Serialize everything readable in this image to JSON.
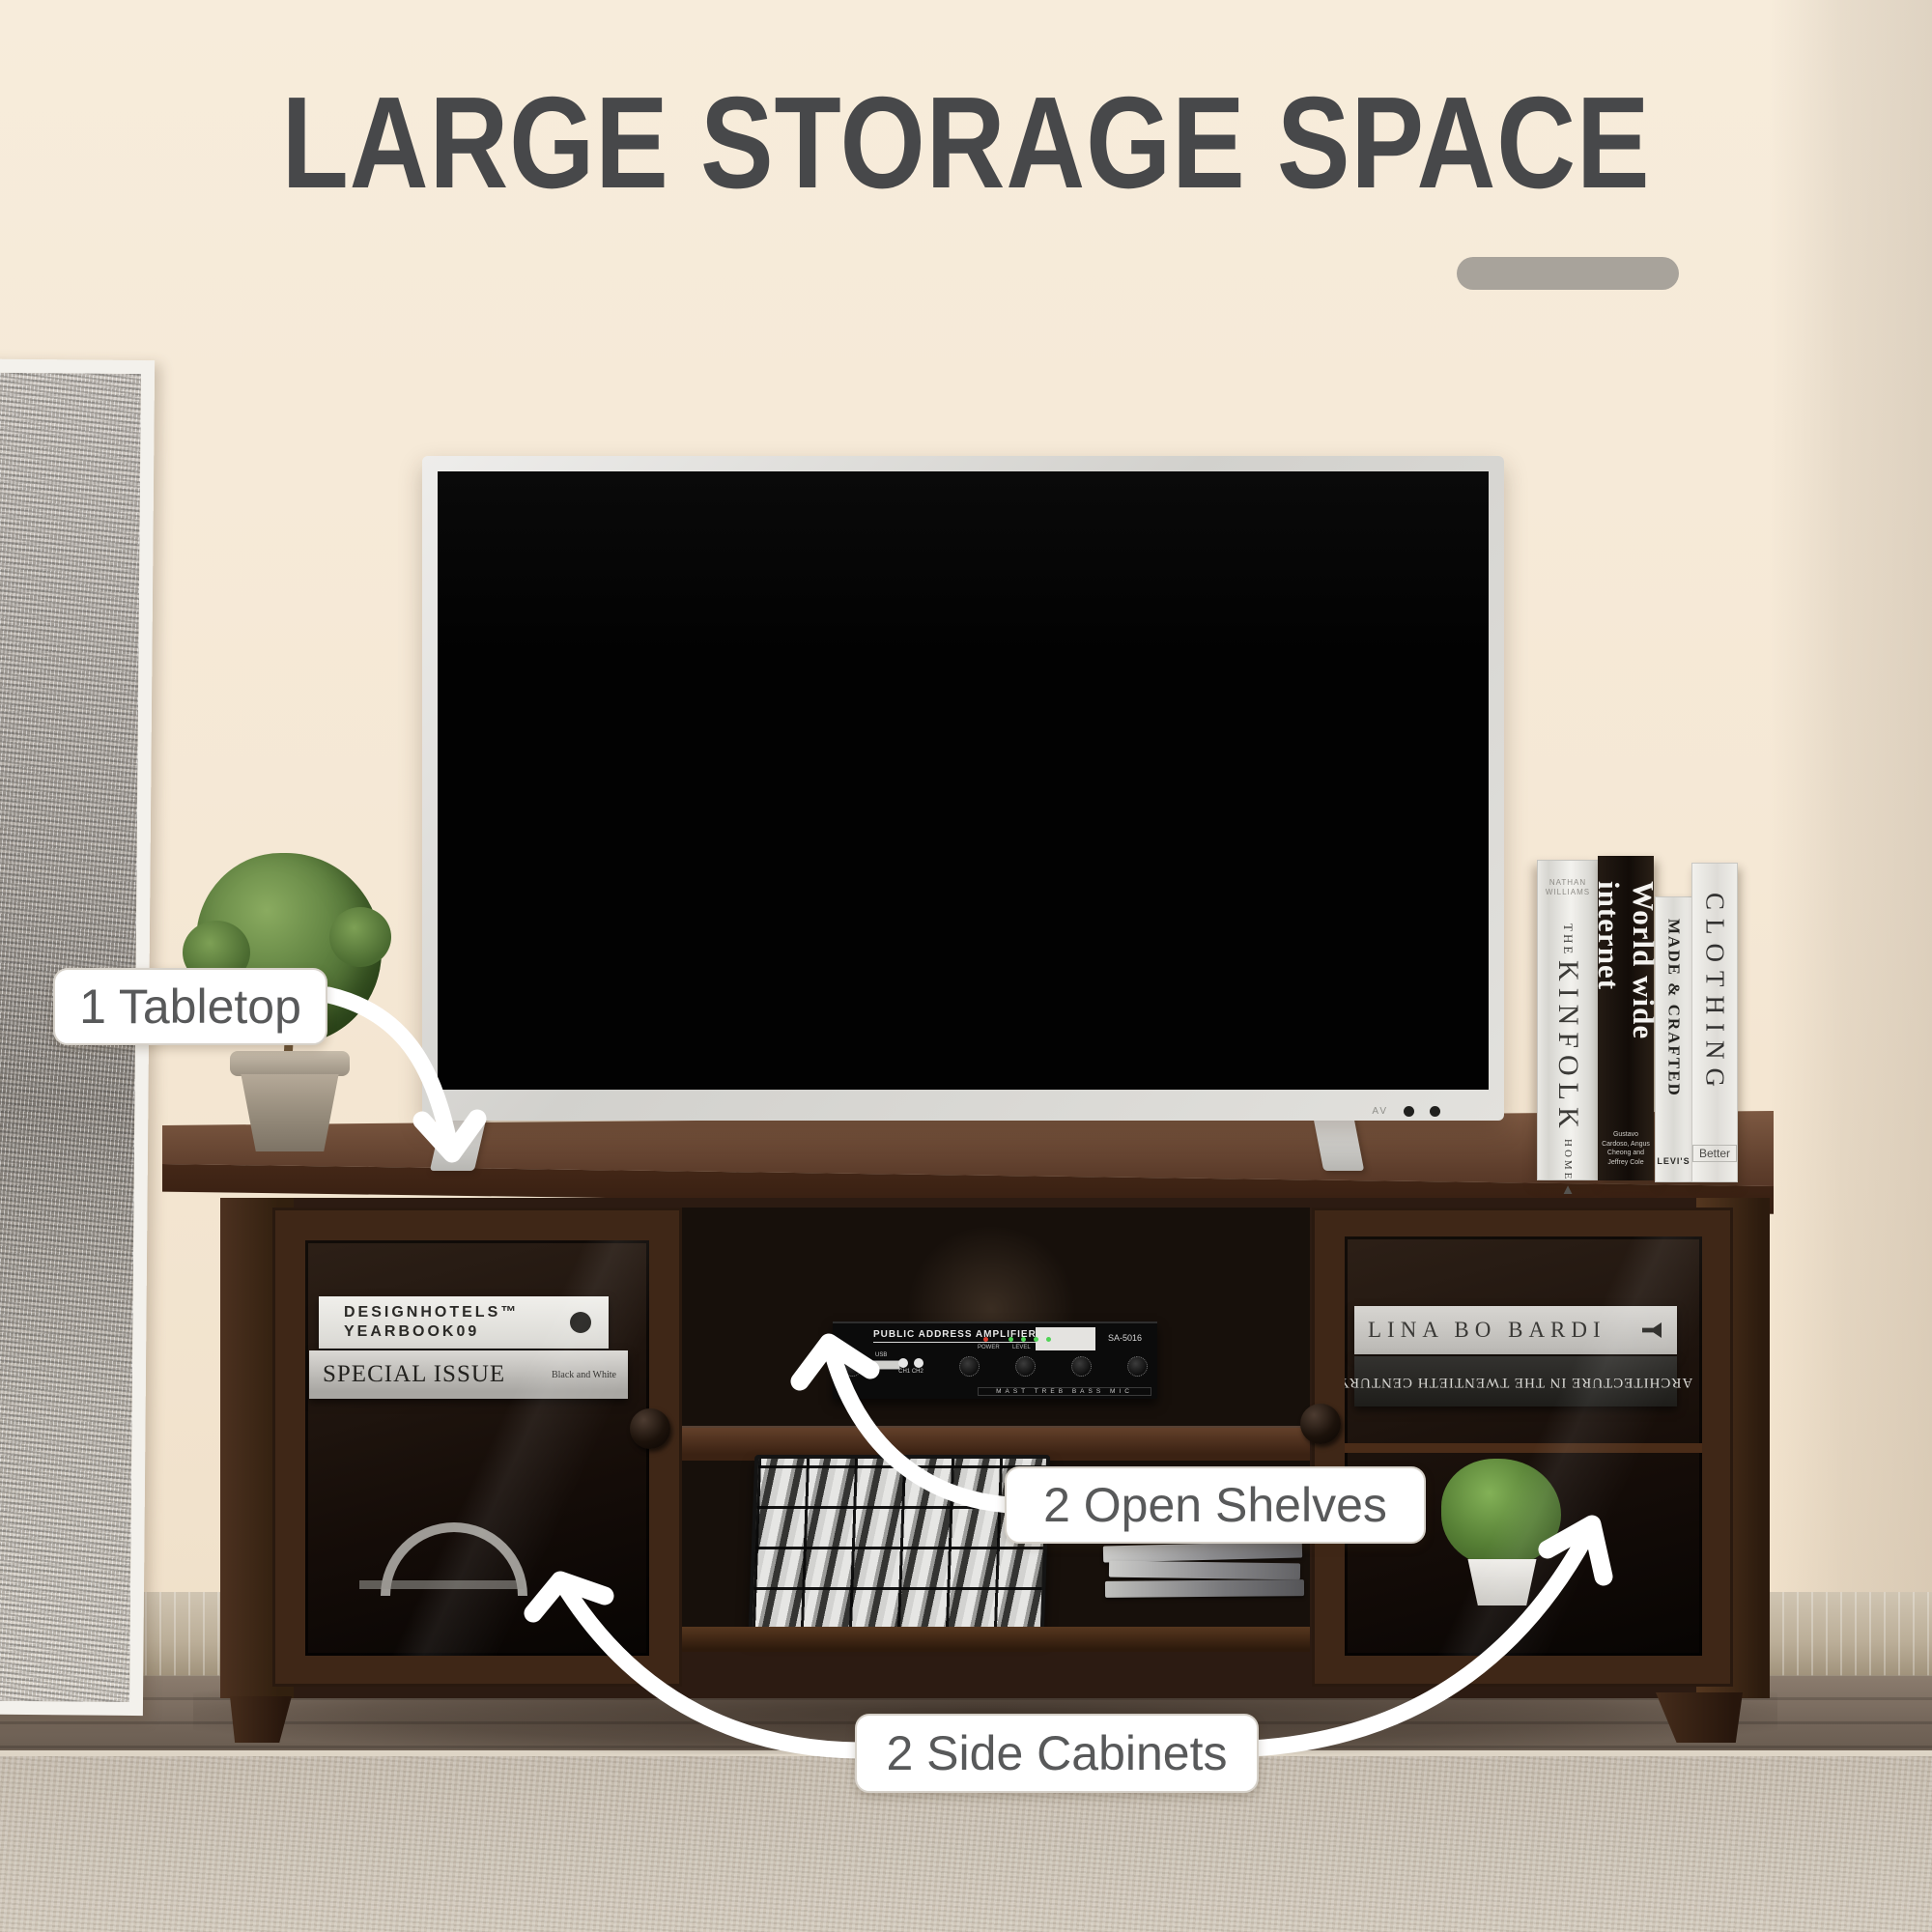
{
  "header": {
    "title": "LARGE STORAGE SPACE"
  },
  "colors": {
    "wall": "#f5e8d5",
    "title_text": "#47484a",
    "accent_bar": "#a8a39b",
    "cabinet_wood": "#3f2717",
    "rug": "#cbc2b4",
    "callout_text": "#58595a",
    "arrow": "#ffffff"
  },
  "callouts": {
    "tabletop": {
      "label": "1 Tabletop"
    },
    "open_shelves": {
      "label": "2 Open Shelves"
    },
    "side_cabinets": {
      "label": "2 Side Cabinets"
    }
  },
  "tabletop_books": {
    "kinfolk": {
      "author": "NATHAN WILLIAMS",
      "the": "THE",
      "title": "KINFOLK",
      "home": "HOME",
      "logo": "▲"
    },
    "www": {
      "title": "World wide internet",
      "authors": "Gustavo Cardoso, Angus Cheong and Jeffrey Cole"
    },
    "made": {
      "title": "MADE & CRAFTED",
      "footer": "LEVI'S"
    },
    "clothing": {
      "title": "CLOTHING",
      "footer": "Better"
    }
  },
  "left_cabinet": {
    "book1": {
      "line1": "DESIGNHOTELS™",
      "line2": "YEARBOOK09"
    },
    "book2": {
      "title": "SPECIAL ISSUE",
      "right": "Black and White"
    }
  },
  "right_cabinet": {
    "book1": {
      "title": "LINA BO BARDI"
    },
    "book2": {
      "title": "ARCHITECTURE IN THE TWENTIETH CENTURY"
    }
  },
  "amp": {
    "brand": "PUBLIC ADDRESS AMPLIFIER",
    "model": "SA-5016",
    "power": "POWER",
    "level": "LEVEL",
    "ch1": "CH1",
    "ch2": "CH2",
    "usb": "USB",
    "eq": "MAST TREB BASS MIC"
  },
  "tv": {
    "av_label": "AV"
  }
}
